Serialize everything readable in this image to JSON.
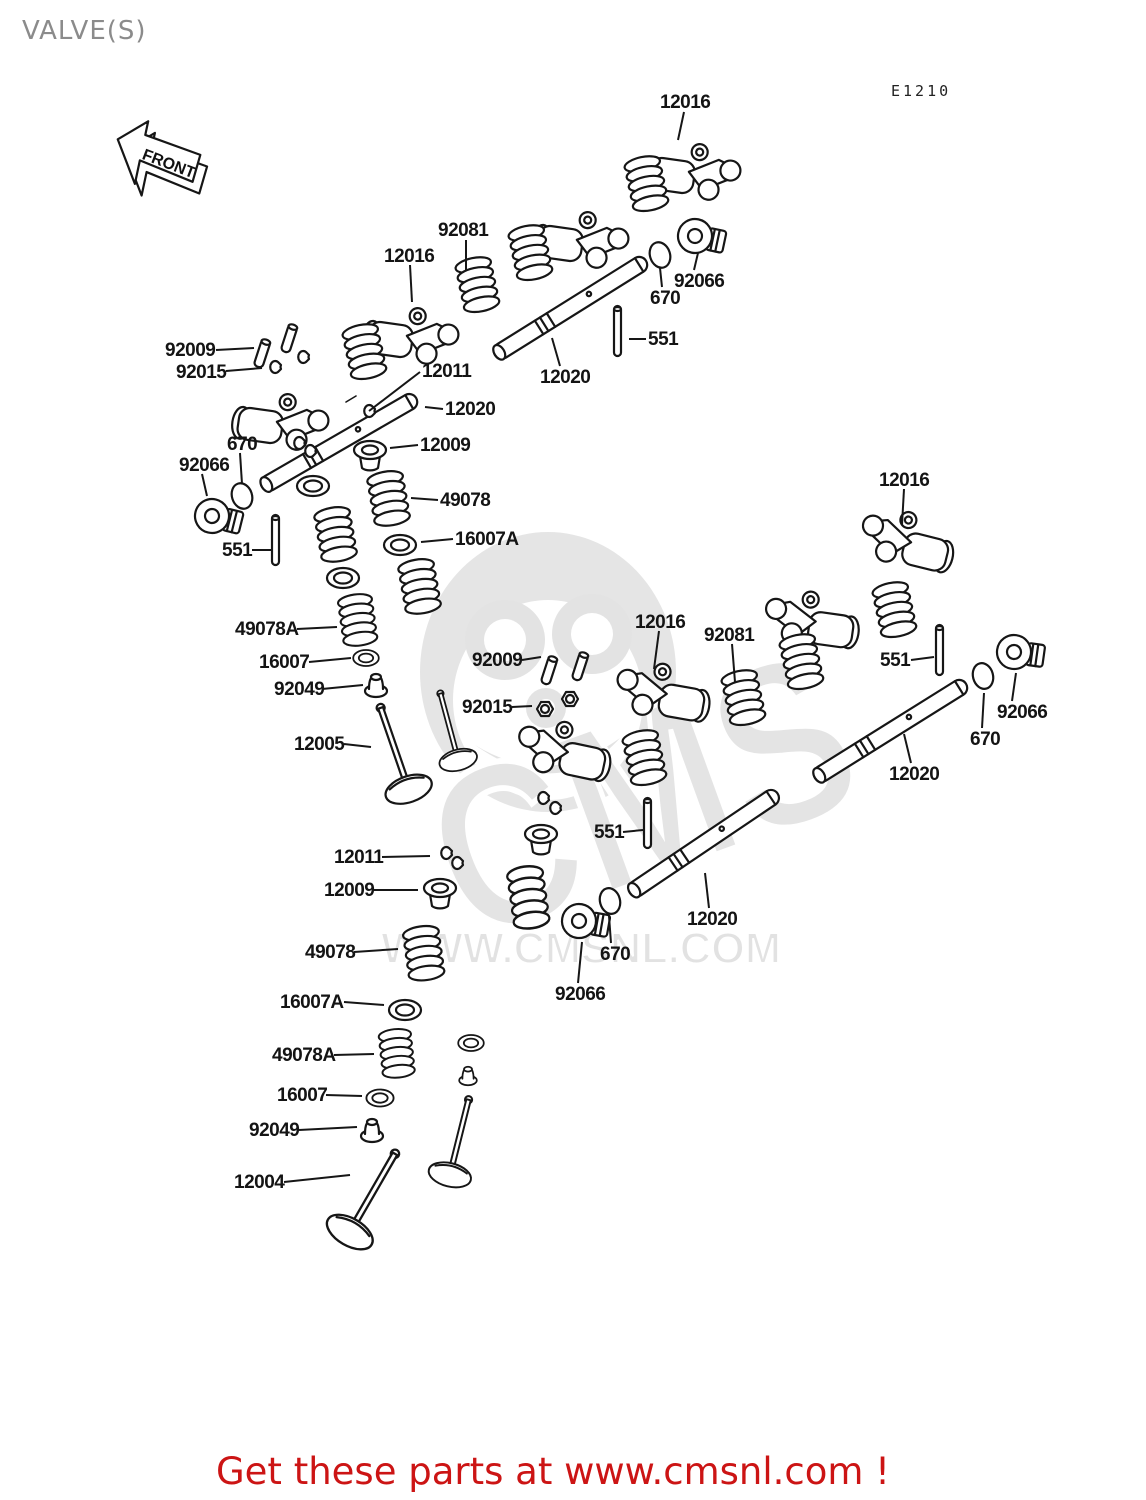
{
  "page": {
    "title": "VALVE(S)",
    "diagram_code": "E1210",
    "front_arrow_label": "FRONT"
  },
  "watermark": {
    "brand": "CMS",
    "url": "WWW.CMSNL.COM"
  },
  "footer": {
    "text": "Get these parts at www.cmsnl.com !",
    "color": "#cc1414"
  },
  "colors": {
    "line": "#161616",
    "title_gray": "#8b8b8b",
    "watermark_gray": "#e3e3e3",
    "footer_red": "#cc1414"
  },
  "callouts": [
    {
      "t": "12016",
      "x": 660,
      "y": 92,
      "l": [
        684,
        112,
        678,
        140
      ]
    },
    {
      "t": "92081",
      "x": 438,
      "y": 220,
      "l": [
        466,
        240,
        466,
        271
      ]
    },
    {
      "t": "12016",
      "x": 384,
      "y": 246,
      "l": [
        410,
        265,
        412,
        302
      ]
    },
    {
      "t": "92066",
      "x": 674,
      "y": 271,
      "l": [
        694,
        270,
        698,
        253
      ]
    },
    {
      "t": "670",
      "x": 650,
      "y": 288,
      "l": [
        662,
        287,
        660,
        268
      ]
    },
    {
      "t": "551",
      "x": 648,
      "y": 329,
      "l": [
        646,
        339,
        629,
        339
      ]
    },
    {
      "t": "12020",
      "x": 540,
      "y": 367,
      "l": [
        560,
        366,
        552,
        338
      ]
    },
    {
      "t": "92009",
      "x": 165,
      "y": 340,
      "l": [
        216,
        350,
        254,
        348
      ]
    },
    {
      "t": "92015",
      "x": 176,
      "y": 362,
      "l": [
        226,
        371,
        262,
        368
      ]
    },
    {
      "t": "12011",
      "x": 422,
      "y": 361,
      "l": [
        420,
        372,
        369,
        411
      ]
    },
    {
      "t": "12020",
      "x": 445,
      "y": 399,
      "l": [
        443,
        409,
        425,
        407
      ]
    },
    {
      "t": "12009",
      "x": 420,
      "y": 435,
      "l": [
        418,
        445,
        390,
        448
      ]
    },
    {
      "t": "670",
      "x": 227,
      "y": 434,
      "l": [
        240,
        453,
        242,
        484
      ]
    },
    {
      "t": "92066",
      "x": 179,
      "y": 455,
      "l": [
        202,
        474,
        207,
        496
      ]
    },
    {
      "t": "551",
      "x": 222,
      "y": 540,
      "l": [
        252,
        550,
        271,
        550
      ]
    },
    {
      "t": "49078",
      "x": 440,
      "y": 490,
      "l": [
        438,
        500,
        411,
        498
      ]
    },
    {
      "t": "16007A",
      "x": 455,
      "y": 529,
      "l": [
        453,
        539,
        421,
        542
      ]
    },
    {
      "t": "49078A",
      "x": 235,
      "y": 619,
      "l": [
        297,
        629,
        337,
        627
      ]
    },
    {
      "t": "16007",
      "x": 259,
      "y": 652,
      "l": [
        309,
        662,
        351,
        658
      ]
    },
    {
      "t": "92049",
      "x": 274,
      "y": 679,
      "l": [
        322,
        689,
        363,
        685
      ]
    },
    {
      "t": "12005",
      "x": 294,
      "y": 734,
      "l": [
        344,
        744,
        371,
        747
      ]
    },
    {
      "t": "92009",
      "x": 472,
      "y": 650,
      "l": [
        522,
        660,
        541,
        657
      ]
    },
    {
      "t": "92015",
      "x": 462,
      "y": 697,
      "l": [
        512,
        707,
        532,
        706
      ]
    },
    {
      "t": "12016",
      "x": 635,
      "y": 612,
      "l": [
        659,
        631,
        654,
        669
      ]
    },
    {
      "t": "92081",
      "x": 704,
      "y": 625,
      "l": [
        732,
        644,
        735,
        682
      ]
    },
    {
      "t": "551",
      "x": 880,
      "y": 650,
      "l": [
        911,
        660,
        934,
        657
      ]
    },
    {
      "t": "92066",
      "x": 997,
      "y": 702,
      "l": [
        1012,
        701,
        1016,
        673
      ]
    },
    {
      "t": "670",
      "x": 970,
      "y": 729,
      "l": [
        982,
        728,
        984,
        693
      ]
    },
    {
      "t": "12020",
      "x": 889,
      "y": 764,
      "l": [
        911,
        763,
        904,
        734
      ]
    },
    {
      "t": "12016",
      "x": 879,
      "y": 470,
      "l": [
        904,
        489,
        902,
        525
      ]
    },
    {
      "t": "551",
      "x": 594,
      "y": 822,
      "l": [
        623,
        832,
        643,
        830
      ]
    },
    {
      "t": "12011",
      "x": 334,
      "y": 847,
      "l": [
        382,
        857,
        430,
        856
      ]
    },
    {
      "t": "12009",
      "x": 324,
      "y": 880,
      "l": [
        373,
        890,
        418,
        890
      ]
    },
    {
      "t": "49078",
      "x": 305,
      "y": 942,
      "l": [
        354,
        952,
        398,
        949
      ]
    },
    {
      "t": "670",
      "x": 600,
      "y": 944,
      "l": [
        611,
        943,
        609,
        916
      ]
    },
    {
      "t": "92066",
      "x": 555,
      "y": 984,
      "l": [
        578,
        983,
        582,
        942
      ]
    },
    {
      "t": "12020",
      "x": 687,
      "y": 909,
      "l": [
        709,
        908,
        705,
        873
      ]
    },
    {
      "t": "16007A",
      "x": 280,
      "y": 992,
      "l": [
        344,
        1002,
        384,
        1005
      ]
    },
    {
      "t": "49078A",
      "x": 272,
      "y": 1045,
      "l": [
        334,
        1055,
        374,
        1054
      ]
    },
    {
      "t": "16007",
      "x": 277,
      "y": 1085,
      "l": [
        326,
        1095,
        362,
        1096
      ]
    },
    {
      "t": "92049",
      "x": 249,
      "y": 1120,
      "l": [
        299,
        1130,
        357,
        1127
      ]
    },
    {
      "t": "12004",
      "x": 234,
      "y": 1172,
      "l": [
        284,
        1182,
        350,
        1175
      ]
    }
  ]
}
